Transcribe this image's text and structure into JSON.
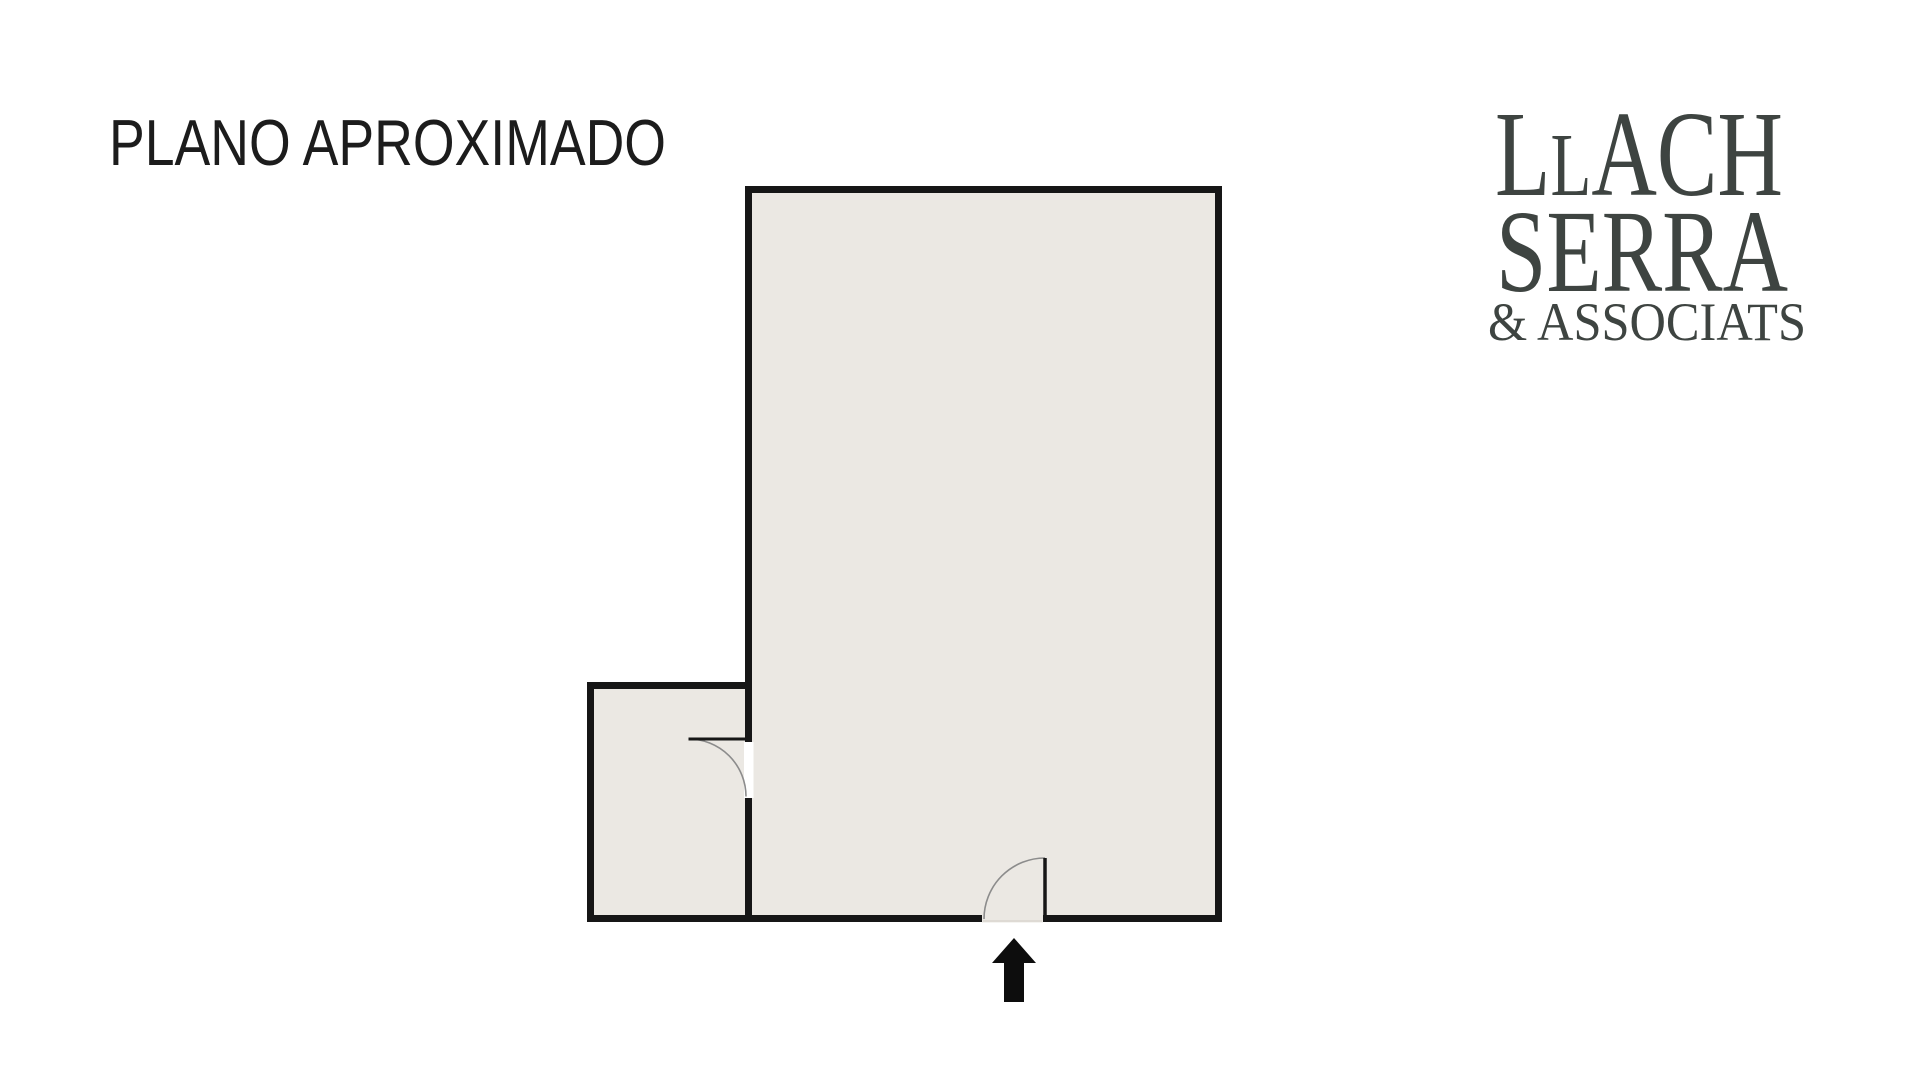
{
  "page": {
    "title": "PLANO APROXIMADO"
  },
  "logo": {
    "company": "LLACH SERRA & ASSOCIATS",
    "line1": {
      "l_tall": "L",
      "l_short": "L",
      "rest": "ACH"
    },
    "line2": "SERRA",
    "line3": "& ASSOCIATS"
  },
  "floorplan": {
    "entrance_arrow_icon": "arrow-up",
    "rooms": [
      "main-room",
      "annex-room"
    ],
    "doors": [
      "interior-door",
      "entrance-door"
    ]
  },
  "colors": {
    "background": "#ffffff",
    "title_text": "#1c1c1c",
    "logo_text": "#3e4441",
    "wall": "#161616",
    "floor": "#ebe8e3",
    "door_gap": "#ffffff",
    "door_arc": "#8c8c8c",
    "threshold": "#d9d5cf",
    "arrow": "#0d0d0d"
  }
}
